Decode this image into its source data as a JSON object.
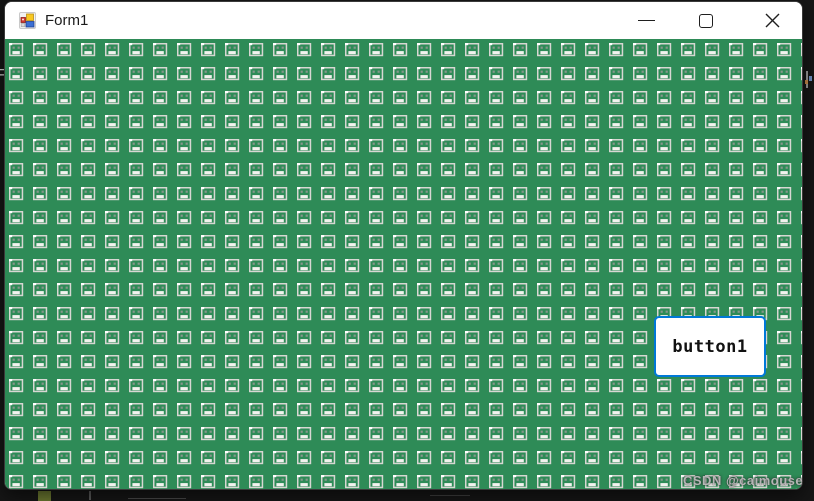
{
  "window": {
    "title": "Form1",
    "controls": {
      "minimize_label": "Minimize",
      "maximize_label": "Maximize",
      "close_label": "Close"
    }
  },
  "icons": {
    "titlebar": "winforms-app-icon",
    "tile": "face-tile-icon",
    "minimize": "minimize-icon",
    "maximize": "maximize-icon",
    "close": "close-icon"
  },
  "client": {
    "background_color": "#2e8b57",
    "tile": {
      "icon": "face-tile-icon",
      "size": 24,
      "offset_x": 4,
      "offset_y": 4,
      "cols": 34,
      "rows": 19,
      "outline_color": "#d7d7d2",
      "highlight_color": "#ffffff",
      "eye_color": "#87978c",
      "mouth_color": "#f2f2ee"
    }
  },
  "button1": {
    "label": "button1",
    "border_color": "#0078d7",
    "text_color": "#111111"
  },
  "watermark": {
    "text": "CSDN @caimouse"
  },
  "desktop_fragments": {
    "left_text": "F"
  }
}
